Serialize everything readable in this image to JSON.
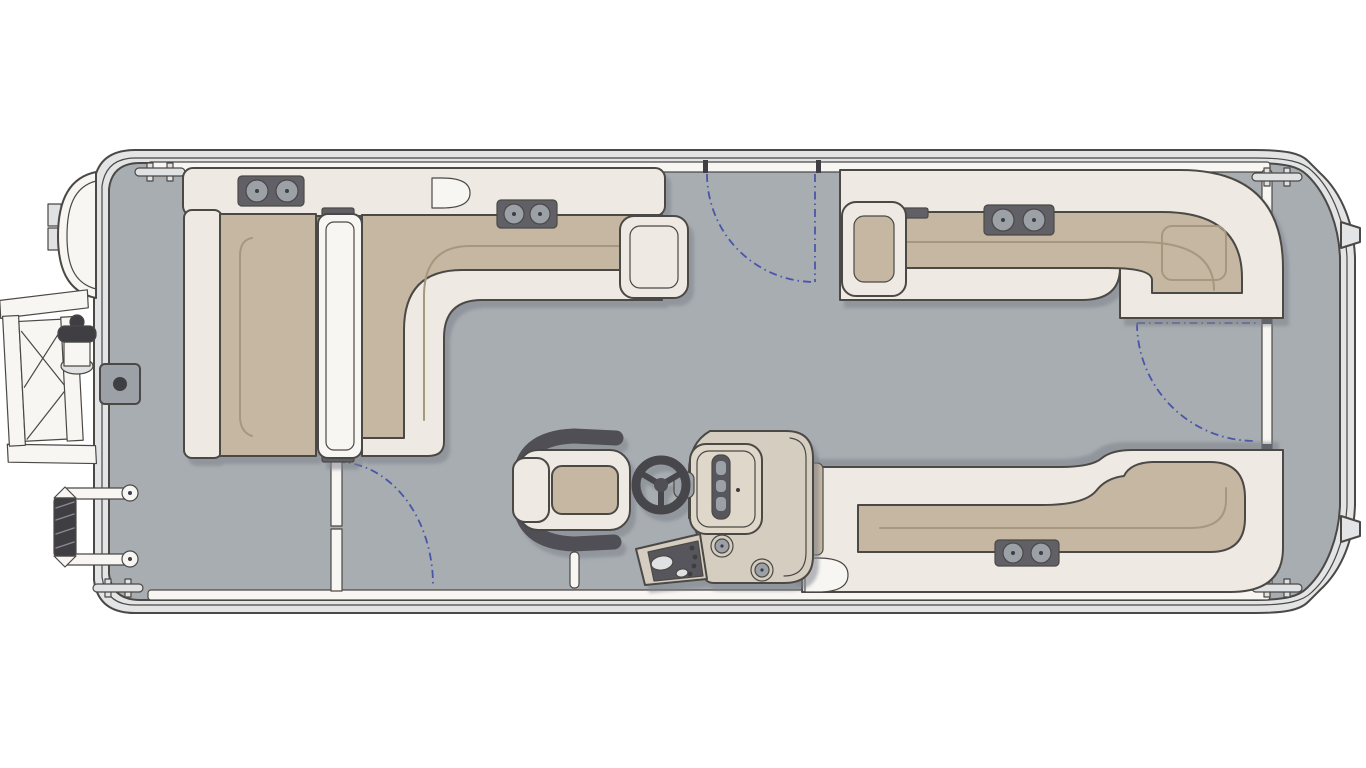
{
  "meta": {
    "description": "Top-view pontoon boat deck floor plan with bow boarding ladder, three entry gates with swing arcs, wraparound lounge seating, captain's chair and helm console"
  },
  "colors": {
    "background": "#ffffff",
    "outline": "#4b4845",
    "deck": "#a8adb2",
    "hull": "#e2e4e5",
    "fence": "#f8f6f3",
    "cushion": "#eee9e2",
    "tan": "#c6b7a2",
    "tanDark": "#a6977f",
    "hardware": "#606066",
    "hardwareDark": "#3e3e43",
    "cup": "#9ba1a6",
    "console": "#d5cdc0",
    "consoleInner": "#ded7ca",
    "consoleDark": "#57575c",
    "chairFrame": "#4f4f54",
    "metal": "#dfe1e2",
    "accent": "#4a55a8"
  },
  "components": [
    "hull",
    "deck",
    "perimeter-fence",
    "mooring-cleats",
    "bow-gate-panel",
    "bow-boarding-ladder",
    "ski-tow-pylon",
    "deck-mount-plate",
    "grab-handle",
    "port-bow-chaise-lounge",
    "flip-backrest",
    "bow-l-lounge",
    "armrests",
    "cupholder-trays",
    "port-side-gate-swing",
    "starboard-bow-gate-swing",
    "stern-gate-swing",
    "stern-starboard-l-lounge",
    "stern-port-bench",
    "aft-deck",
    "captains-chair",
    "helm-console",
    "steering-wheel",
    "switch-panel",
    "console-cupholders"
  ],
  "counts": {
    "gates": 3,
    "cleats": 4,
    "cupholder_trays": 4,
    "console_cupholders": 2
  }
}
